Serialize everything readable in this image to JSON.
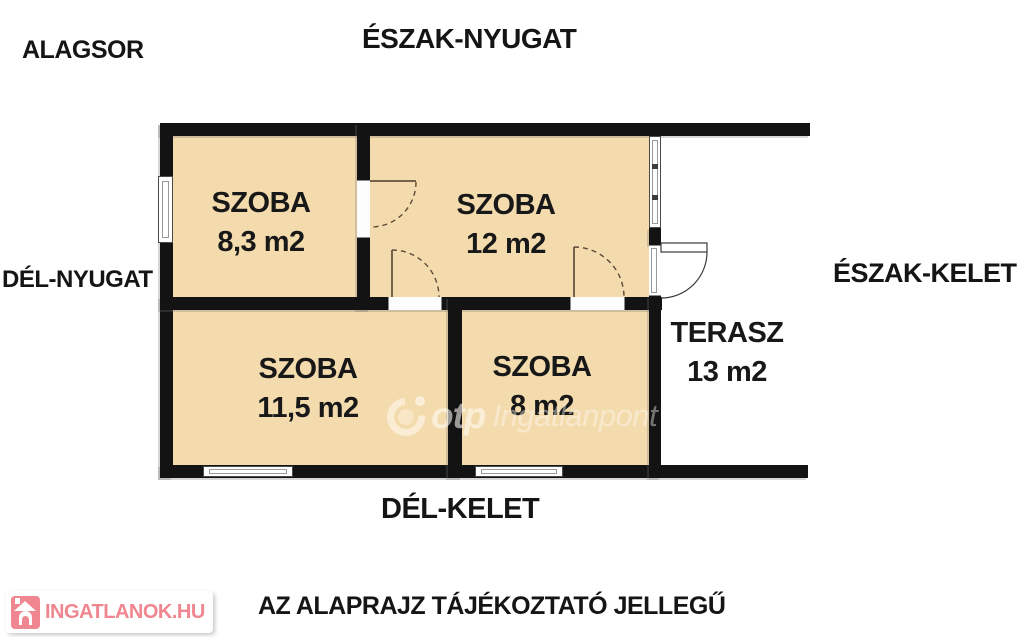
{
  "plan": {
    "floor_label": "ALAGSOR",
    "orientations": {
      "north_west": "ÉSZAK-NYUGAT",
      "south_west": "DÉL-NYUGAT",
      "north_east": "ÉSZAK-KELET",
      "south_east": "DÉL-KELET"
    },
    "rooms": [
      {
        "name": "SZOBA",
        "area": "8,3 m2"
      },
      {
        "name": "SZOBA",
        "area": "12 m2"
      },
      {
        "name": "SZOBA",
        "area": "11,5 m2"
      },
      {
        "name": "SZOBA",
        "area": "8 m2"
      },
      {
        "name": "TERASZ",
        "area": "13 m2"
      }
    ],
    "disclaimer": "AZ ALAPRAJZ TÁJÉKOZTATÓ JELLEGŰ"
  },
  "watermark": {
    "brand": "otp",
    "product": "Ingatlanpont"
  },
  "footer_logo": {
    "text": "INGATLANOK.HU"
  },
  "colors": {
    "room_fill": "#f4dbae",
    "wall": "#131313",
    "brand_pink": "#f0868f",
    "door_arc": "#5d4a37"
  }
}
